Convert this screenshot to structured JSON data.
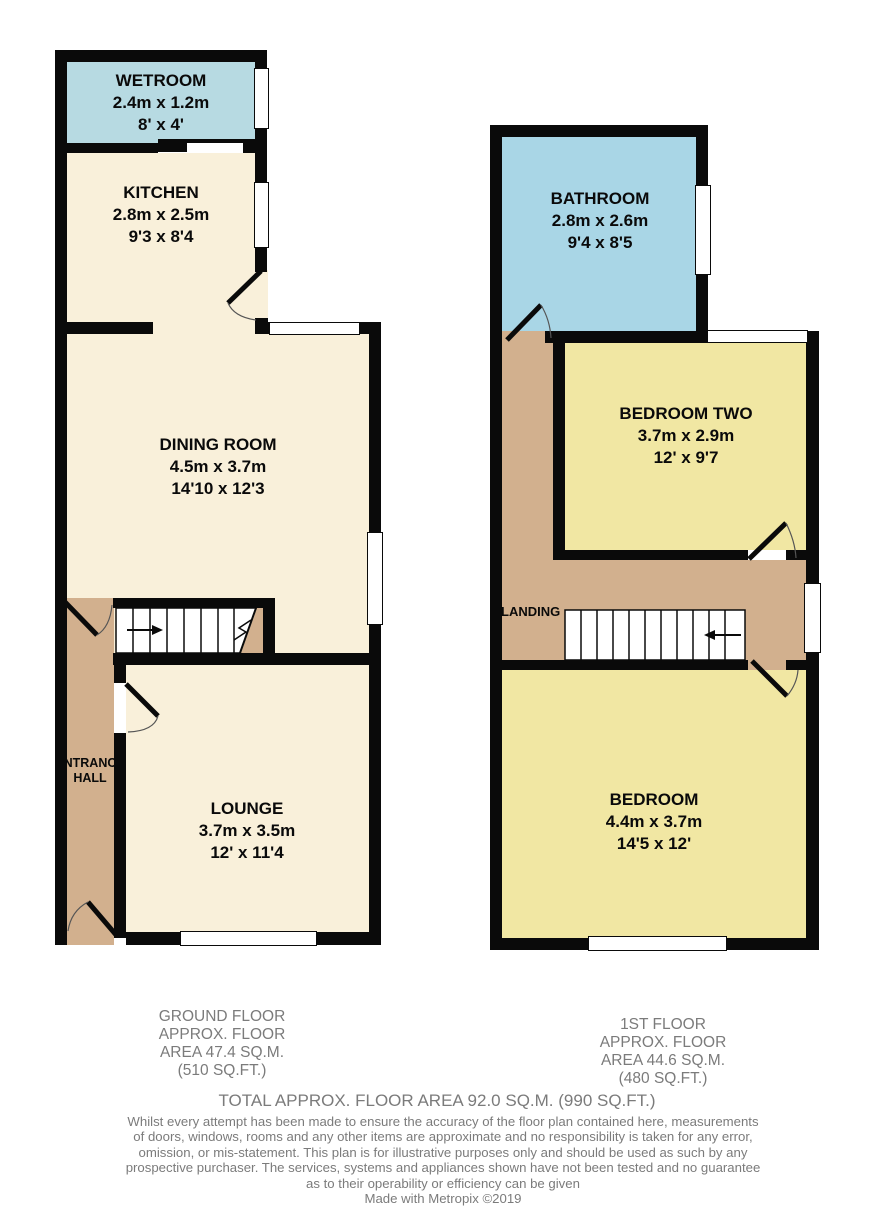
{
  "ground_floor": {
    "rooms": {
      "wetroom": {
        "name": "WETROOM",
        "metric": "2.4m x 1.2m",
        "imperial": "8' x 4'"
      },
      "kitchen": {
        "name": "KITCHEN",
        "metric": "2.8m x 2.5m",
        "imperial": "9'3 x 8'4"
      },
      "dining": {
        "name": "DINING ROOM",
        "metric": "4.5m x 3.7m",
        "imperial": "14'10 x 12'3"
      },
      "entrance_hall": {
        "line1": "ENTRANCE",
        "line2": "HALL"
      },
      "lounge": {
        "name": "LOUNGE",
        "metric": "3.7m x 3.5m",
        "imperial": "12' x 11'4"
      }
    },
    "summary": [
      "GROUND FLOOR",
      "APPROX. FLOOR",
      "AREA 47.4 SQ.M.",
      "(510 SQ.FT.)"
    ]
  },
  "first_floor": {
    "rooms": {
      "bathroom": {
        "name": "BATHROOM",
        "metric": "2.8m x 2.6m",
        "imperial": "9'4 x 8'5"
      },
      "bedroom_two": {
        "name": "BEDROOM TWO",
        "metric": "3.7m x 2.9m",
        "imperial": "12' x 9'7"
      },
      "landing": {
        "name": "LANDING"
      },
      "bedroom": {
        "name": "BEDROOM",
        "metric": "4.4m x 3.7m",
        "imperial": "14'5 x 12'"
      }
    },
    "summary": [
      "1ST FLOOR",
      "APPROX. FLOOR",
      "AREA 44.6 SQ.M.",
      "(480 SQ.FT.)"
    ]
  },
  "footer": {
    "total": "TOTAL APPROX. FLOOR AREA 92.0 SQ.M. (990 SQ.FT.)",
    "disclaimer": [
      "Whilst every attempt has been made to ensure the accuracy of the floor plan contained here, measurements",
      "of doors, windows, rooms and any other items are approximate and no responsibility is taken for any error,",
      "omission, or mis-statement. This plan is for illustrative purposes only and should be used as such by any",
      "prospective purchaser. The services, systems and appliances shown have not been tested and no guarantee",
      "as to their operability or efficiency can be given"
    ],
    "credit": "Made with Metropix ©2019"
  },
  "colors": {
    "wall": "#0a0a0a",
    "room_cream": "#f9f0da",
    "room_yellow": "#f1e7a3",
    "wetroom_blue": "#b7dae2",
    "bathroom_blue": "#a9d6e6",
    "hallway_tan": "#d2b08e",
    "footer_text_gray": "#7b7b7b"
  }
}
